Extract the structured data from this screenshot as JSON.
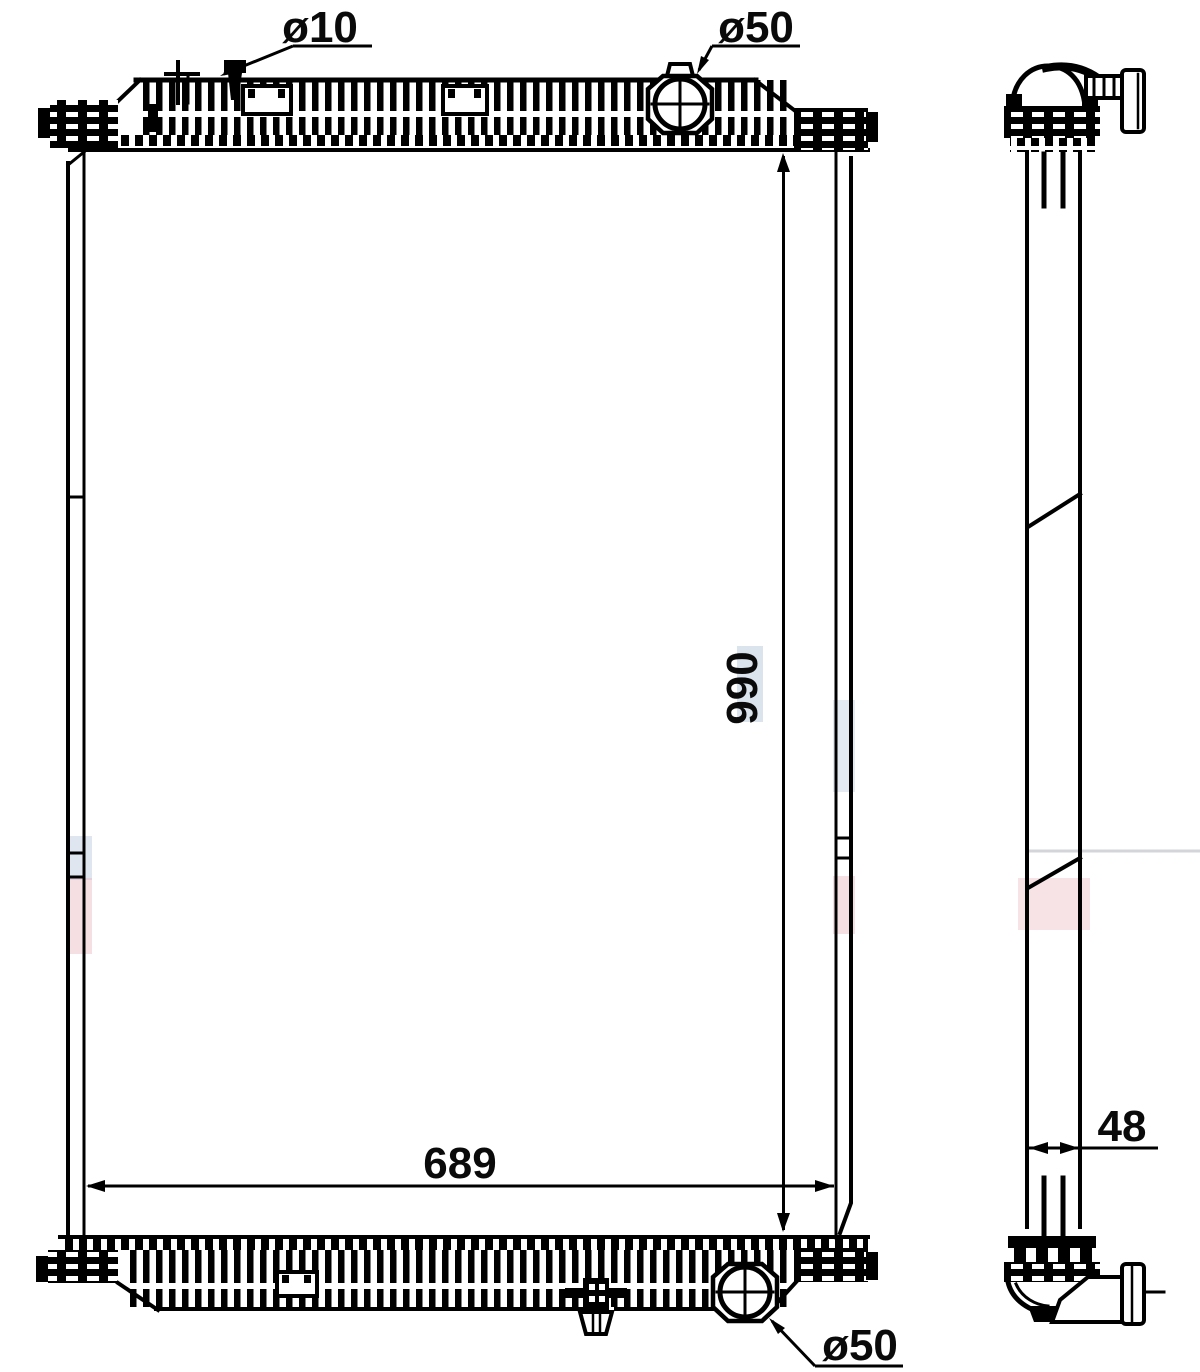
{
  "drawing": {
    "description": "radiator-two-view-technical-drawing",
    "dimensions": {
      "top_fitting": "ø10",
      "top_inlet": "ø50",
      "core_height": "990",
      "core_width": "689",
      "core_depth": "48",
      "bottom_outlet": "ø50"
    },
    "colors": {
      "line": "#000000",
      "background": "#ffffff",
      "watermark_pink": "#eab3bd",
      "watermark_blue": "#b7c8dc",
      "watermark_gray": "#a8adb5"
    }
  }
}
